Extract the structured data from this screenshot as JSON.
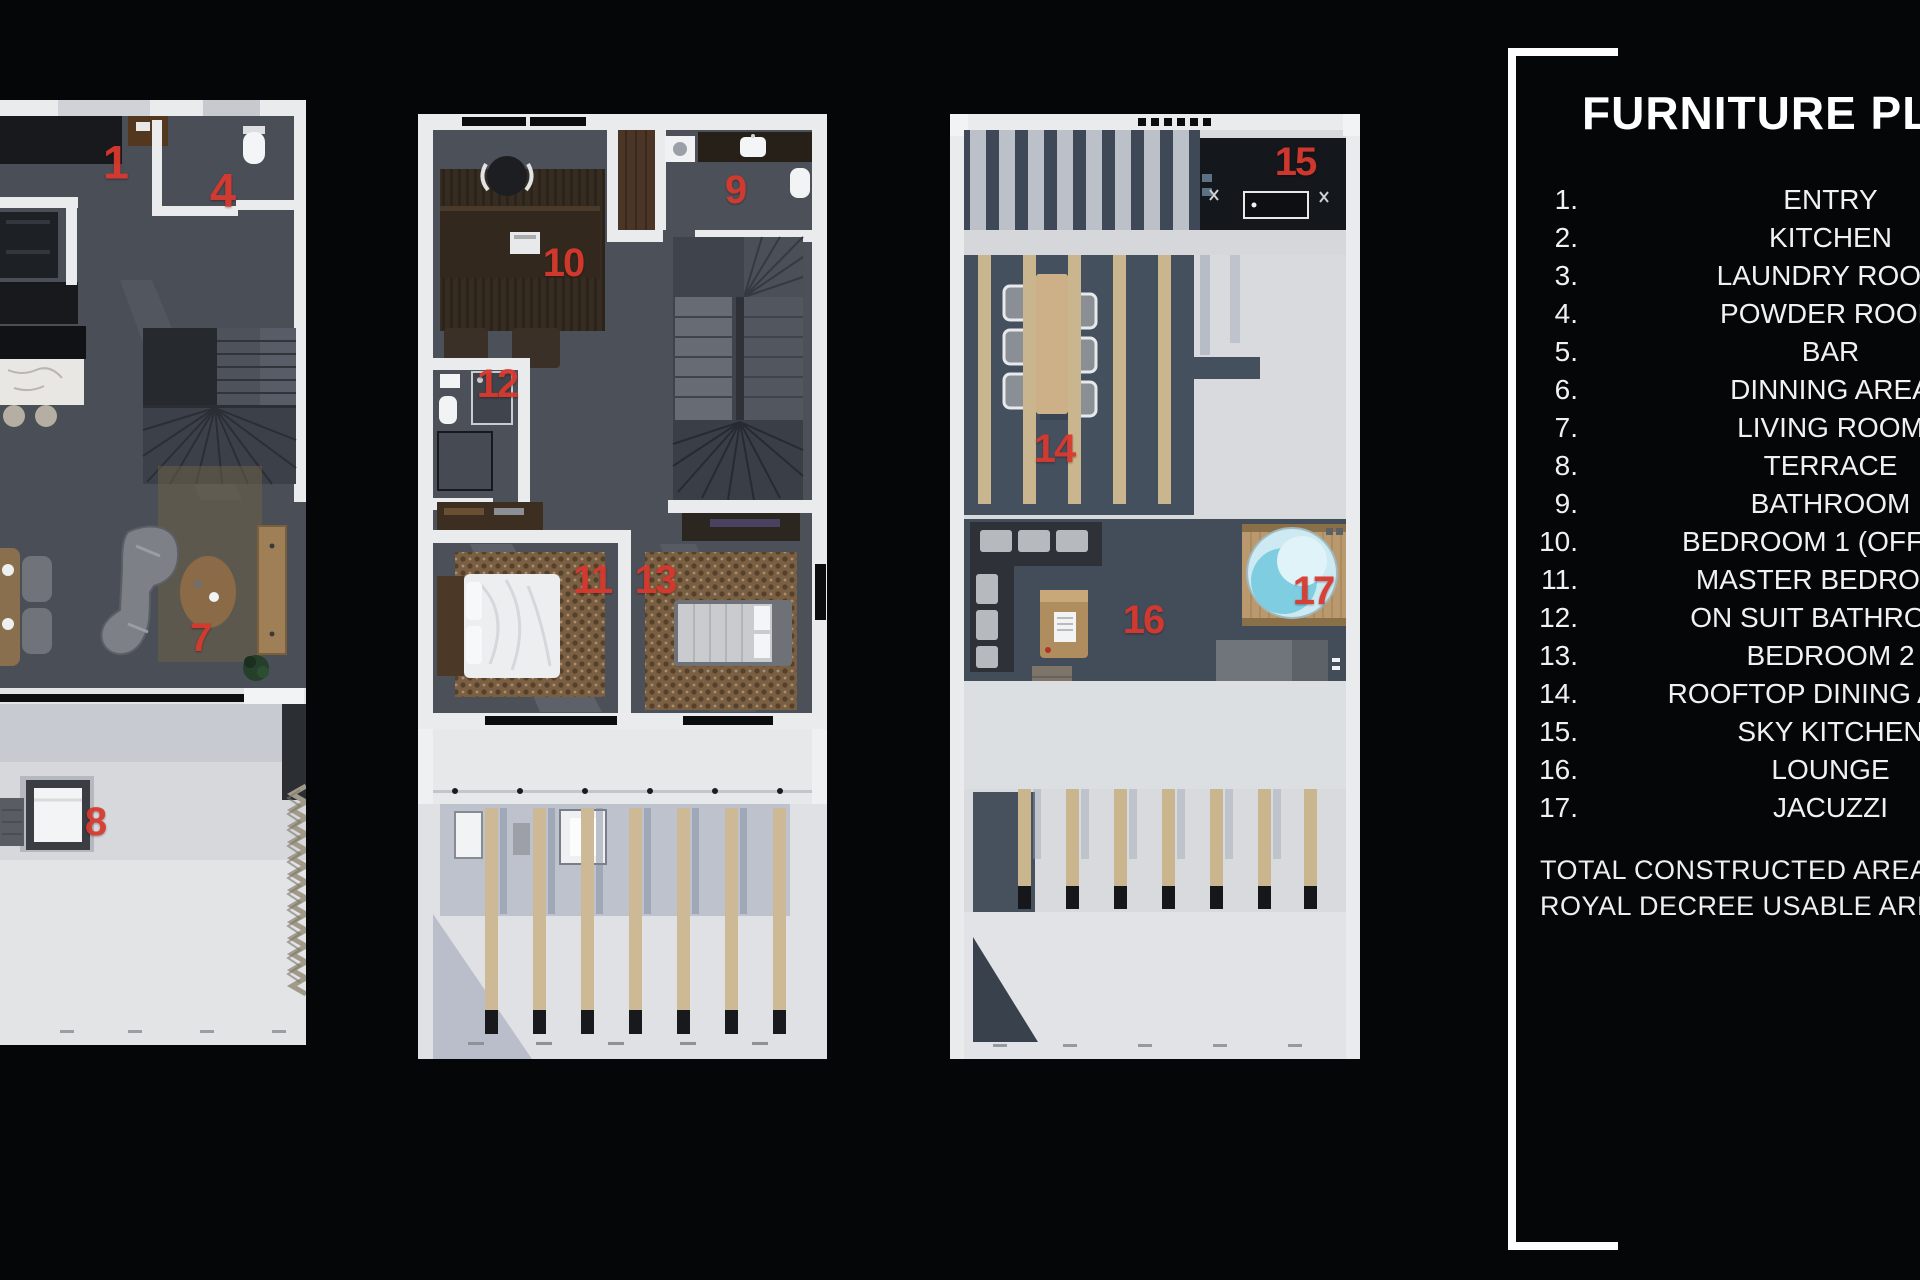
{
  "colors": {
    "background": "#050608",
    "accent_red": "#d8392e",
    "wall_white": "#e9ebed",
    "floor_dark": "#4b5059",
    "concrete_light": "#dadce0",
    "wood_tan": "#c9b58e",
    "jacuzzi_blue": "#7fcde1"
  },
  "legend": {
    "title": "FURNITURE PLAN",
    "items": [
      {
        "num": "1.",
        "label": "ENTRY"
      },
      {
        "num": "2.",
        "label": "KITCHEN"
      },
      {
        "num": "3.",
        "label": "LAUNDRY ROOM"
      },
      {
        "num": "4.",
        "label": "POWDER ROOM"
      },
      {
        "num": "5.",
        "label": "BAR"
      },
      {
        "num": "6.",
        "label": "DINNING AREA"
      },
      {
        "num": "7.",
        "label": "LIVING ROOM"
      },
      {
        "num": "8.",
        "label": "TERRACE"
      },
      {
        "num": "9.",
        "label": "BATHROOM"
      },
      {
        "num": "10.",
        "label": "BEDROOM 1 (OFFICE)"
      },
      {
        "num": "11.",
        "label": "MASTER BEDROOM"
      },
      {
        "num": "12.",
        "label": "ON SUIT BATHROOM"
      },
      {
        "num": "13.",
        "label": "BEDROOM 2"
      },
      {
        "num": "14.",
        "label": "ROOFTOP DINING AREA"
      },
      {
        "num": "15.",
        "label": "SKY KITCHEN"
      },
      {
        "num": "16.",
        "label": "LOUNGE"
      },
      {
        "num": "17.",
        "label": "JACUZZI"
      }
    ],
    "totals": [
      "TOTAL CONSTRUCTED AREA: 2",
      "ROYAL DECREE USABLE AREA:"
    ]
  },
  "plans": {
    "p1": {
      "title": "ground floor plan",
      "markers": [
        {
          "n": "1"
        },
        {
          "n": "4"
        },
        {
          "n": "7"
        },
        {
          "n": "8"
        }
      ]
    },
    "p2": {
      "title": "first floor plan",
      "markers": [
        {
          "n": "9"
        },
        {
          "n": "10"
        },
        {
          "n": "12"
        },
        {
          "n": "11"
        },
        {
          "n": "13"
        }
      ]
    },
    "p3": {
      "title": "rooftop plan",
      "markers": [
        {
          "n": "15"
        },
        {
          "n": "14"
        },
        {
          "n": "16"
        },
        {
          "n": "17"
        }
      ]
    }
  }
}
